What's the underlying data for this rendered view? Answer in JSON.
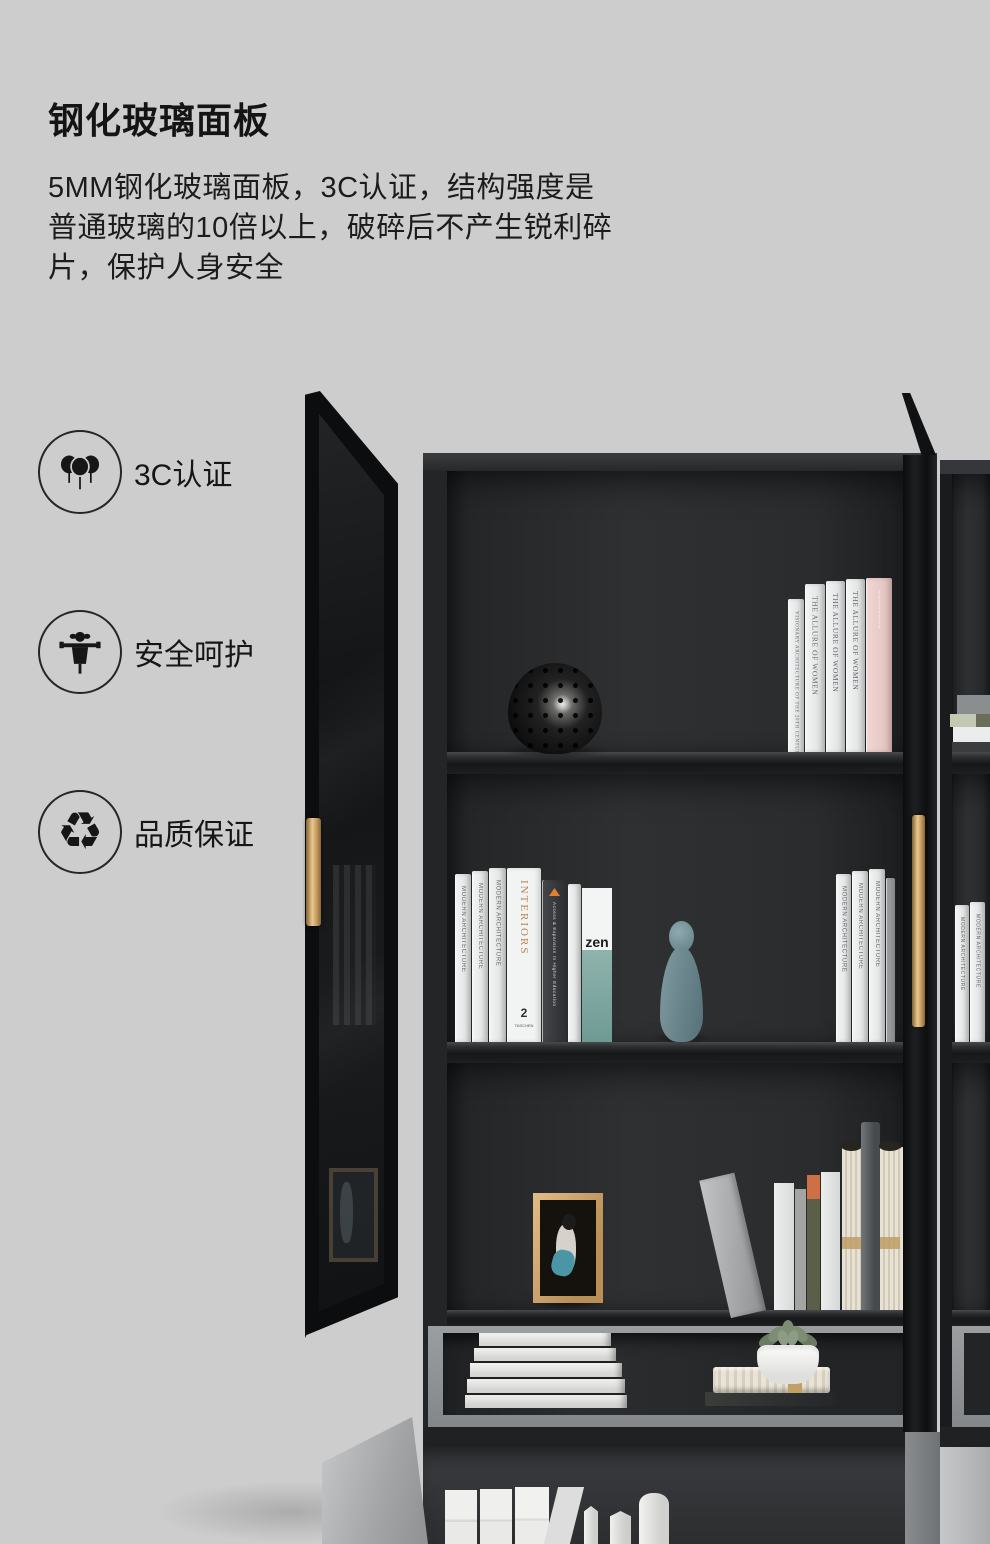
{
  "page": {
    "background_color": "#cdcdce",
    "accent_gold": "#d8b278",
    "cabinet_dark": "#26282a"
  },
  "header": {
    "title": "钢化玻璃面板",
    "description_lines": [
      "5MM钢化玻璃面板，3C认证，结构强度是",
      "普通玻璃的10倍以上，破碎后不产生锐利碎",
      "片，保护人身安全"
    ]
  },
  "features": [
    {
      "icon": "ccc-certification-icon",
      "label": "3C认证"
    },
    {
      "icon": "scarecrow-safety-icon",
      "label": "安全呵护"
    },
    {
      "icon": "recycle-icon",
      "label": "品质保证",
      "glyph": "♻"
    }
  ],
  "scene": {
    "caption": "black bookcase with tempered glass doors, gold handles, books and decor",
    "book_spines": {
      "allure": "THE ALLURE OF WOMEN",
      "visionary": "VISIONARY ARCHITECTURE OF THE 20TH CENTURY",
      "modern": "MODERN ARCHITECTURE",
      "interiors": "INTERIORS",
      "access": "Access & Expansion In Higher Education",
      "zen": "zen",
      "taschen_number": "2",
      "taschen": "TASCHEN"
    }
  }
}
